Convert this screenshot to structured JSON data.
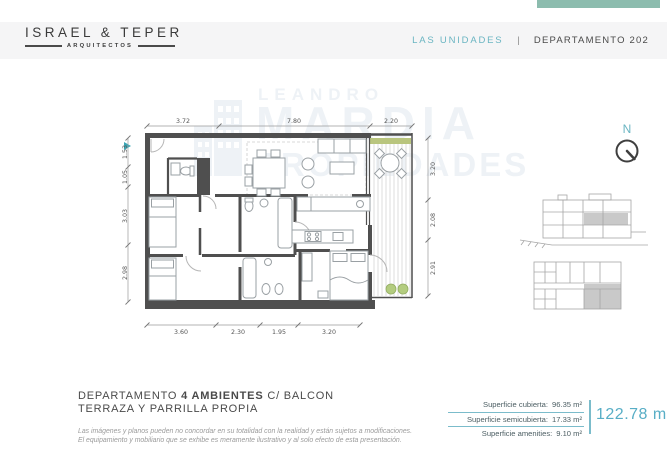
{
  "brand": {
    "name": "ISRAEL & TEPER",
    "tagline": "ARQUITECTOS"
  },
  "header": {
    "nav_label": "LAS UNIDADES",
    "separator": "|",
    "unit_label": "DEPARTAMENTO 202"
  },
  "watermark": {
    "line1": "LEANDRO",
    "line2": "MARDIA",
    "line3": "PROPIEDADES"
  },
  "compass": {
    "label": "N"
  },
  "plan": {
    "dims_top": [
      "3.72",
      "7.80",
      "2.20"
    ],
    "dims_bottom": [
      "3.60",
      "2.30",
      "1.95",
      "3.20"
    ],
    "dims_left": [
      "1.53",
      "1.05",
      "3.03",
      "2.98"
    ],
    "dims_right": [
      "3.20",
      "2.08",
      "2.91"
    ]
  },
  "footer": {
    "title_part1": "DEPARTAMENTO",
    "title_part2": "4 AMBIENTES",
    "title_part3": "C/ BALCON",
    "title_line2": "TERRAZA Y PARRILLA PROPIA",
    "disclaimer1": "Las imágenes y planos pueden no concordar en su totalidad con la realidad y están sujetos a modificaciones.",
    "disclaimer2": "El equipamiento y mobiliario que se exhibe es meramente ilustrativo y al solo efecto de esta presentación.",
    "areas": [
      {
        "label": "Superficie cubierta:",
        "value": "96.35 m²"
      },
      {
        "label": "Superficie semicubierta:",
        "value": "17.33 m²"
      },
      {
        "label": "Superficie amenities:",
        "value": "9.10 m²"
      }
    ],
    "total": "122.78 m²"
  },
  "colors": {
    "accent": "#58aec6",
    "accent_light": "#7bbccb",
    "wall": "#4f4f4f",
    "planter_green": "#b3cc7f",
    "watermark": "#eef2f6"
  }
}
